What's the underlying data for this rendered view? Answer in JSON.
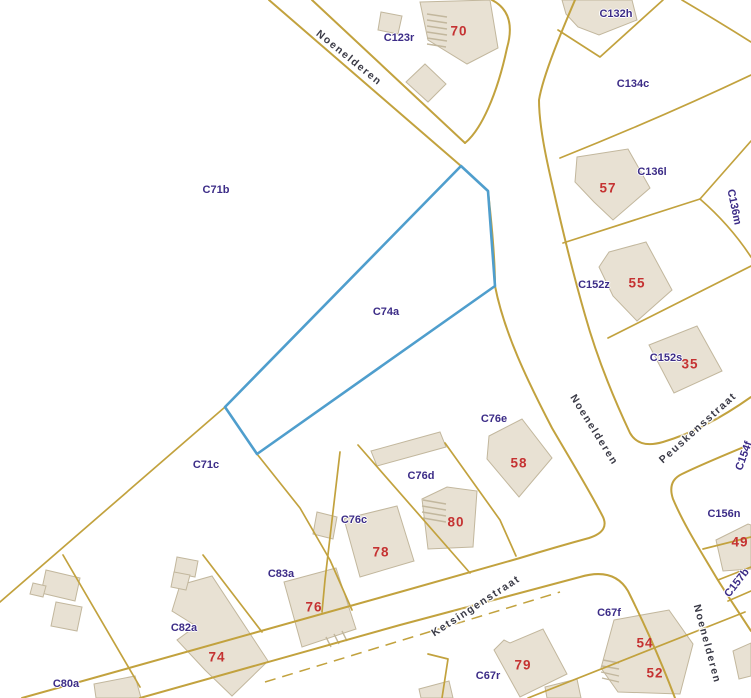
{
  "map": {
    "colors": {
      "boundary": "#c2a23e",
      "building_fill": "#e8e1d3",
      "building_stroke": "#c2b79d",
      "parcel_label": "#3c2c87",
      "house_number": "#c53232",
      "street_label": "#3a3a46",
      "highlight": "#4f9ecd"
    },
    "highlight": {
      "parcel": "C74a"
    },
    "street_labels": [
      {
        "text": "Noenelderen",
        "x": 349,
        "y": 58,
        "angle": 39
      },
      {
        "text": "Noenelderen",
        "x": 594,
        "y": 430,
        "angle": 58
      },
      {
        "text": "Noenelderen",
        "x": 707,
        "y": 644,
        "angle": 75
      },
      {
        "text": "Ketsingenstraat",
        "x": 476,
        "y": 606,
        "angle": -33
      },
      {
        "text": "Peuskensstraat",
        "x": 698,
        "y": 428,
        "angle": -42
      }
    ],
    "parcel_labels": [
      {
        "text": "C123r",
        "x": 399,
        "y": 38,
        "angle": 0
      },
      {
        "text": "C132h",
        "x": 616,
        "y": 14,
        "angle": 0
      },
      {
        "text": "C134c",
        "x": 633,
        "y": 84,
        "angle": 0
      },
      {
        "text": "C136l",
        "x": 652,
        "y": 172,
        "angle": 0
      },
      {
        "text": "C136m",
        "x": 734,
        "y": 207,
        "angle": 78
      },
      {
        "text": "C152z",
        "x": 594,
        "y": 285,
        "angle": 0
      },
      {
        "text": "C152s",
        "x": 666,
        "y": 358,
        "angle": 0
      },
      {
        "text": "C71b",
        "x": 216,
        "y": 190,
        "angle": 0
      },
      {
        "text": "C74a",
        "x": 386,
        "y": 312,
        "angle": 0
      },
      {
        "text": "C71c",
        "x": 206,
        "y": 465,
        "angle": 0
      },
      {
        "text": "C76e",
        "x": 494,
        "y": 419,
        "angle": 0
      },
      {
        "text": "C76d",
        "x": 421,
        "y": 476,
        "angle": 0
      },
      {
        "text": "C76c",
        "x": 354,
        "y": 520,
        "angle": 0
      },
      {
        "text": "C83a",
        "x": 281,
        "y": 574,
        "angle": 0
      },
      {
        "text": "C82a",
        "x": 184,
        "y": 628,
        "angle": 0
      },
      {
        "text": "C80a",
        "x": 66,
        "y": 684,
        "angle": 0
      },
      {
        "text": "C67f",
        "x": 609,
        "y": 613,
        "angle": 0
      },
      {
        "text": "C67r",
        "x": 488,
        "y": 676,
        "angle": 0
      },
      {
        "text": "C156n",
        "x": 724,
        "y": 514,
        "angle": 0
      },
      {
        "text": "C154f",
        "x": 744,
        "y": 456,
        "angle": -70
      },
      {
        "text": "C157b",
        "x": 737,
        "y": 583,
        "angle": -52
      }
    ],
    "house_numbers": [
      {
        "text": "70",
        "x": 459,
        "y": 31
      },
      {
        "text": "57",
        "x": 608,
        "y": 188
      },
      {
        "text": "55",
        "x": 637,
        "y": 283
      },
      {
        "text": "35",
        "x": 690,
        "y": 364
      },
      {
        "text": "58",
        "x": 519,
        "y": 463
      },
      {
        "text": "80",
        "x": 456,
        "y": 522
      },
      {
        "text": "78",
        "x": 381,
        "y": 552
      },
      {
        "text": "76",
        "x": 314,
        "y": 607
      },
      {
        "text": "74",
        "x": 217,
        "y": 657
      },
      {
        "text": "79",
        "x": 523,
        "y": 665
      },
      {
        "text": "54",
        "x": 645,
        "y": 643
      },
      {
        "text": "52",
        "x": 655,
        "y": 673
      },
      {
        "text": "49",
        "x": 740,
        "y": 542
      }
    ]
  }
}
